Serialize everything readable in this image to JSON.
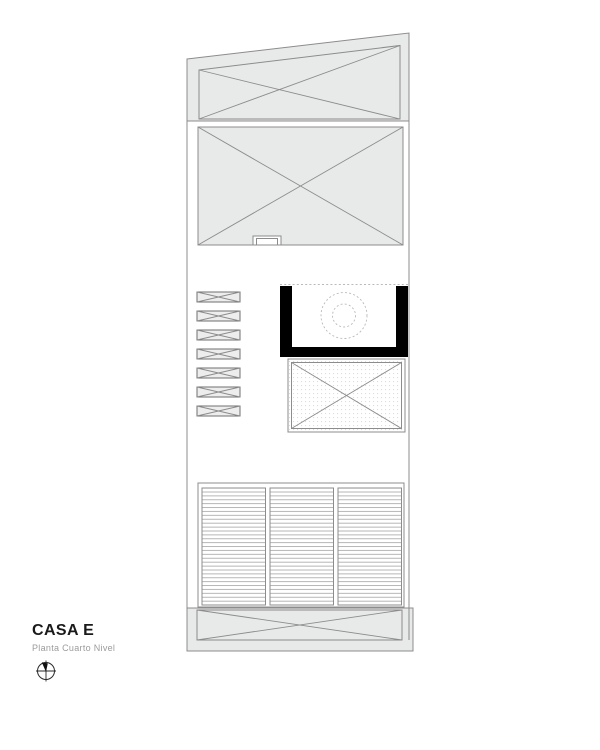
{
  "title_block": {
    "title": "CASA E",
    "subtitle": "Planta Cuarto Nivel",
    "north_arrow_icon": "north-arrow-compass"
  },
  "plan": {
    "stair_slats": {
      "count": 7
    },
    "deck_panels": {
      "count": 3
    },
    "colors": {
      "fill_gray": "#e8e9e9",
      "line_gray": "#8c8c8c",
      "dash_gray": "#bababa",
      "wall_black": "#000000",
      "deck_line": "#a3a3a3",
      "hatch_dot": "#dcdcdc",
      "title_color": "#1a1a1a",
      "subtitle_color": "#9b9b9b"
    }
  }
}
